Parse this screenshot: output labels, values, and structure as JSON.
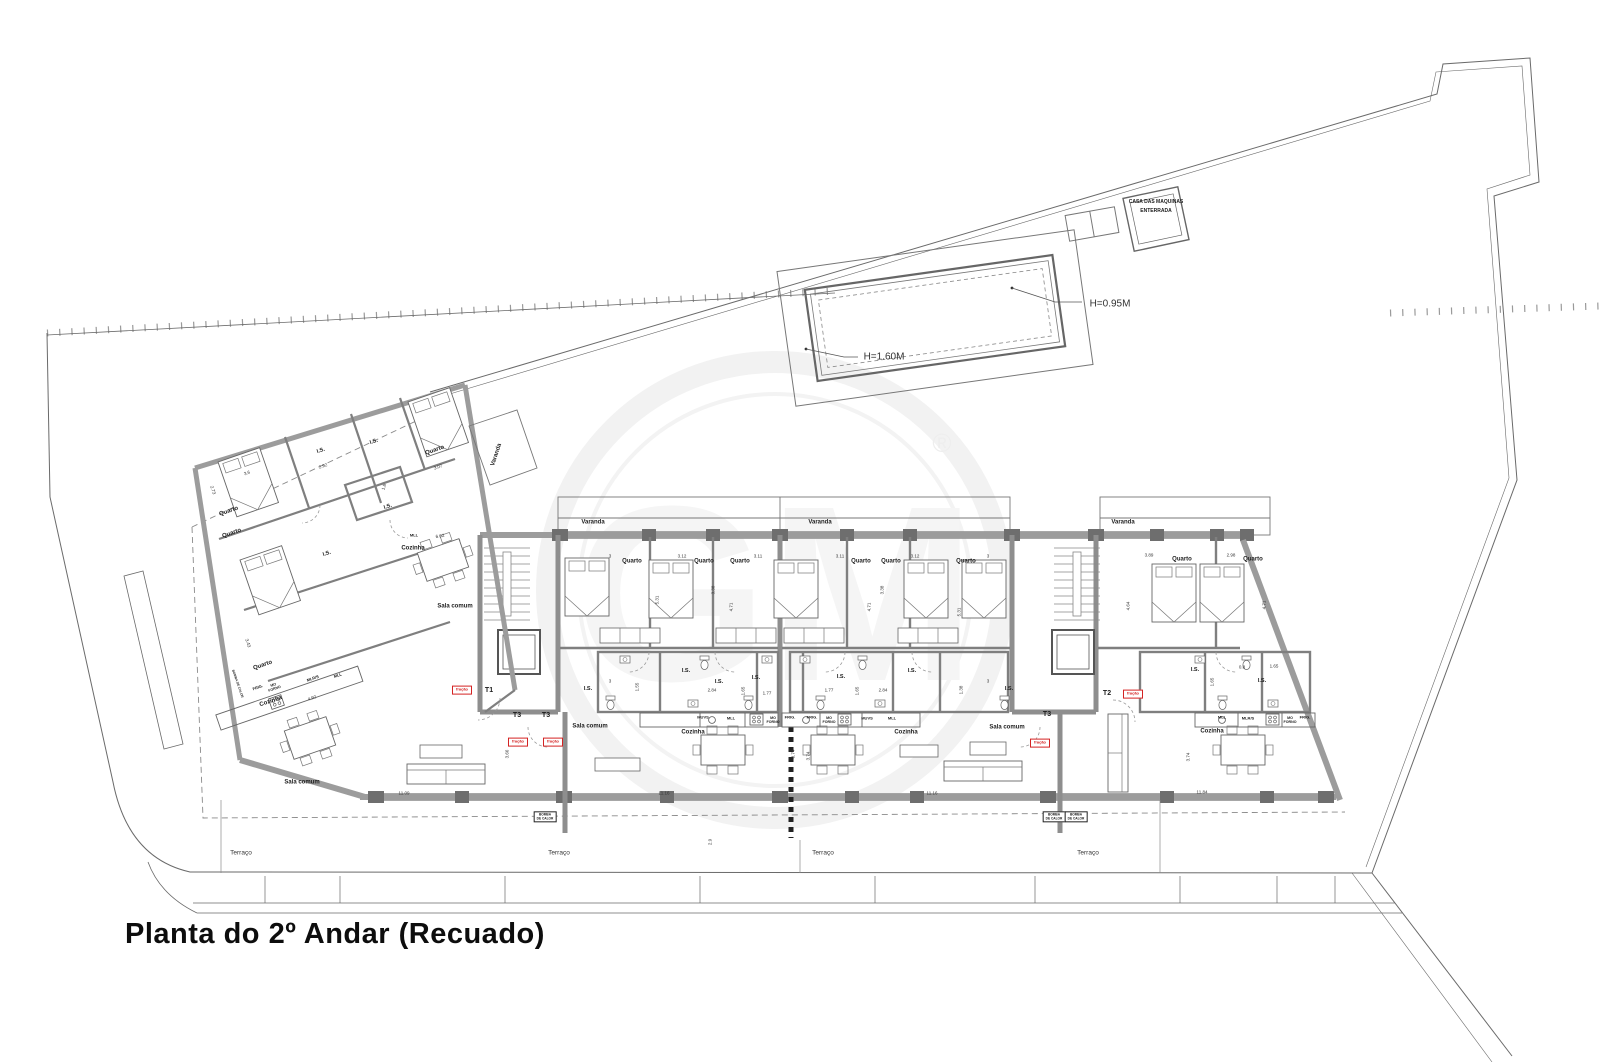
{
  "title": "Planta do 2º Andar (Recuado)",
  "watermark": {
    "text": "GM",
    "reg": "®"
  },
  "pool": {
    "depth_deep": "H=1.60M",
    "depth_shallow": "H=0.95M",
    "machine_house_line1": "CASA DAS MAQUINAS",
    "machine_house_line2": "ENTERRADA"
  },
  "unit_tags": [
    "T1",
    "T3",
    "T3",
    "T3",
    "T2"
  ],
  "fraction_tags": [
    {
      "t": "fração",
      "x": 462,
      "y": 690
    },
    {
      "t": "fração",
      "x": 518,
      "y": 742
    },
    {
      "t": "fração",
      "x": 553,
      "y": 742
    },
    {
      "t": "fração",
      "x": 1040,
      "y": 743
    },
    {
      "t": "fração",
      "x": 1133,
      "y": 694
    }
  ],
  "labels": [
    {
      "t": "H=0.95M",
      "x": 1110,
      "y": 304,
      "s": 10,
      "b": 0
    },
    {
      "t": "H=1.60M",
      "x": 884,
      "y": 357,
      "s": 10,
      "b": 0
    },
    {
      "t": "CASA DAS MAQUINAS",
      "x": 1156,
      "y": 203,
      "s": 5,
      "b": 1
    },
    {
      "t": "ENTERRADA",
      "x": 1156,
      "y": 212,
      "s": 5,
      "b": 1
    },
    {
      "t": "Varanda",
      "x": 593,
      "y": 523,
      "s": 6,
      "b": 1
    },
    {
      "t": "Varanda",
      "x": 820,
      "y": 523,
      "s": 6,
      "b": 1
    },
    {
      "t": "Varanda",
      "x": 1123,
      "y": 523,
      "s": 6,
      "b": 1
    },
    {
      "t": "Varanda",
      "x": 497,
      "y": 455,
      "s": 6,
      "b": 1,
      "r": -72
    },
    {
      "t": "Quarto",
      "x": 632,
      "y": 562,
      "s": 6,
      "b": 1
    },
    {
      "t": "Quarto",
      "x": 704,
      "y": 562,
      "s": 6,
      "b": 1
    },
    {
      "t": "Quarto",
      "x": 740,
      "y": 562,
      "s": 6,
      "b": 1
    },
    {
      "t": "Quarto",
      "x": 861,
      "y": 562,
      "s": 6,
      "b": 1
    },
    {
      "t": "Quarto",
      "x": 891,
      "y": 562,
      "s": 6,
      "b": 1
    },
    {
      "t": "Quarto",
      "x": 966,
      "y": 562,
      "s": 6,
      "b": 1
    },
    {
      "t": "Quarto",
      "x": 1182,
      "y": 560,
      "s": 6,
      "b": 1
    },
    {
      "t": "Quarto",
      "x": 1253,
      "y": 560,
      "s": 6,
      "b": 1
    },
    {
      "t": "Quarto",
      "x": 229,
      "y": 512,
      "s": 6,
      "b": 1,
      "r": -19
    },
    {
      "t": "Quarto",
      "x": 232,
      "y": 534,
      "s": 6,
      "b": 1,
      "r": -19
    },
    {
      "t": "Quarto",
      "x": 435,
      "y": 451,
      "s": 6,
      "b": 1,
      "r": -19
    },
    {
      "t": "Quarto",
      "x": 263,
      "y": 666,
      "s": 6,
      "b": 1,
      "r": -19
    },
    {
      "t": "I.S.",
      "x": 321,
      "y": 451,
      "s": 5.5,
      "b": 1,
      "r": -19
    },
    {
      "t": "I.S.",
      "x": 374,
      "y": 442,
      "s": 5.5,
      "b": 1,
      "r": -19
    },
    {
      "t": "I.S.",
      "x": 388,
      "y": 507,
      "s": 5.5,
      "b": 1,
      "r": -19
    },
    {
      "t": "I.S.",
      "x": 327,
      "y": 554,
      "s": 5.5,
      "b": 1,
      "r": -19
    },
    {
      "t": "I.S.",
      "x": 588,
      "y": 689,
      "s": 5.5,
      "b": 1
    },
    {
      "t": "I.S.",
      "x": 686,
      "y": 671,
      "s": 5.5,
      "b": 1
    },
    {
      "t": "I.S.",
      "x": 719,
      "y": 682,
      "s": 5.5,
      "b": 1
    },
    {
      "t": "I.S.",
      "x": 756,
      "y": 678,
      "s": 5.5,
      "b": 1
    },
    {
      "t": "I.S.",
      "x": 841,
      "y": 677,
      "s": 5.5,
      "b": 1
    },
    {
      "t": "I.S.",
      "x": 912,
      "y": 671,
      "s": 5.5,
      "b": 1
    },
    {
      "t": "I.S.",
      "x": 1009,
      "y": 689,
      "s": 5.5,
      "b": 1
    },
    {
      "t": "I.S.",
      "x": 1195,
      "y": 670,
      "s": 5.5,
      "b": 1
    },
    {
      "t": "I.S.",
      "x": 1262,
      "y": 681,
      "s": 5.5,
      "b": 1
    },
    {
      "t": "Cozinha",
      "x": 413,
      "y": 549,
      "s": 6,
      "b": 1
    },
    {
      "t": "Cozinha",
      "x": 271,
      "y": 702,
      "s": 6,
      "b": 1,
      "r": -19
    },
    {
      "t": "Cozinha",
      "x": 693,
      "y": 733,
      "s": 6,
      "b": 1
    },
    {
      "t": "Cozinha",
      "x": 906,
      "y": 733,
      "s": 6,
      "b": 1
    },
    {
      "t": "Cozinha",
      "x": 1212,
      "y": 732,
      "s": 6,
      "b": 1
    },
    {
      "t": "Sala comum",
      "x": 455,
      "y": 607,
      "s": 6,
      "b": 1
    },
    {
      "t": "Sala comum",
      "x": 302,
      "y": 783,
      "s": 6,
      "b": 1
    },
    {
      "t": "Sala comum",
      "x": 590,
      "y": 727,
      "s": 6,
      "b": 1
    },
    {
      "t": "Sala comum",
      "x": 1007,
      "y": 728,
      "s": 6,
      "b": 1
    },
    {
      "t": "MUVS",
      "x": 703,
      "y": 718,
      "s": 4,
      "b": 1
    },
    {
      "t": "MLL",
      "x": 731,
      "y": 719,
      "s": 4,
      "b": 1
    },
    {
      "t": "MO\nFORNO",
      "x": 773,
      "y": 720,
      "s": 3.6,
      "b": 1
    },
    {
      "t": "FRIG.",
      "x": 790,
      "y": 718,
      "s": 4,
      "b": 1
    },
    {
      "t": "FRIG.",
      "x": 812,
      "y": 718,
      "s": 4,
      "b": 1
    },
    {
      "t": "MO\nFORNO",
      "x": 829,
      "y": 720,
      "s": 3.6,
      "b": 1
    },
    {
      "t": "MUVS",
      "x": 867,
      "y": 719,
      "s": 4,
      "b": 1
    },
    {
      "t": "MLL",
      "x": 892,
      "y": 719,
      "s": 4,
      "b": 1
    },
    {
      "t": "MLL",
      "x": 1222,
      "y": 718,
      "s": 4,
      "b": 1
    },
    {
      "t": "MLR/S",
      "x": 1248,
      "y": 719,
      "s": 4,
      "b": 1
    },
    {
      "t": "MO\nFORNO",
      "x": 1290,
      "y": 720,
      "s": 3.6,
      "b": 1
    },
    {
      "t": "FRIG.",
      "x": 1305,
      "y": 718,
      "s": 4,
      "b": 1
    },
    {
      "t": "FRIG.",
      "x": 258,
      "y": 688,
      "s": 4,
      "b": 1,
      "r": -19
    },
    {
      "t": "MO\nFORNO",
      "x": 274,
      "y": 687,
      "s": 3.6,
      "b": 1,
      "r": -19
    },
    {
      "t": "MLR/S",
      "x": 313,
      "y": 679,
      "s": 4,
      "b": 1,
      "r": -19
    },
    {
      "t": "MLL",
      "x": 338,
      "y": 676,
      "s": 4,
      "b": 1,
      "r": -19
    },
    {
      "t": "MLL",
      "x": 414,
      "y": 536,
      "s": 4,
      "b": 1
    },
    {
      "t": "T1",
      "x": 489,
      "y": 691,
      "s": 7,
      "b": 1
    },
    {
      "t": "T3",
      "x": 517,
      "y": 716,
      "s": 7,
      "b": 1
    },
    {
      "t": "T3",
      "x": 546,
      "y": 716,
      "s": 7,
      "b": 1
    },
    {
      "t": "T3",
      "x": 1047,
      "y": 715,
      "s": 7,
      "b": 1
    },
    {
      "t": "T2",
      "x": 1107,
      "y": 694,
      "s": 7,
      "b": 1
    },
    {
      "t": "Terraço",
      "x": 241,
      "y": 853,
      "s": 6.5,
      "b": 0
    },
    {
      "t": "Terraço",
      "x": 559,
      "y": 853,
      "s": 6.5,
      "b": 0
    },
    {
      "t": "Terraço",
      "x": 823,
      "y": 853,
      "s": 6.5,
      "b": 0
    },
    {
      "t": "Terraço",
      "x": 1088,
      "y": 853,
      "s": 6.5,
      "b": 0
    },
    {
      "t": "BOMBA\nDE CALOR",
      "x": 545,
      "y": 817,
      "s": 3.2,
      "b": 1,
      "box": 1
    },
    {
      "t": "BOMBA\nDE CALOR",
      "x": 1054,
      "y": 817,
      "s": 3.2,
      "b": 1,
      "box": 1
    },
    {
      "t": "BOMBA\nDE CALOR",
      "x": 1076,
      "y": 817,
      "s": 3.2,
      "b": 1,
      "box": 1
    },
    {
      "t": "BOMBA DE CALOR",
      "x": 237,
      "y": 684,
      "s": 3.2,
      "b": 1,
      "r": 71
    },
    {
      "t": "3",
      "x": 610,
      "y": 556,
      "s": 4.5,
      "b": 0
    },
    {
      "t": "3.12",
      "x": 682,
      "y": 556,
      "s": 4.5,
      "b": 0
    },
    {
      "t": "3.11",
      "x": 758,
      "y": 556,
      "s": 4.5,
      "b": 0
    },
    {
      "t": "3.11",
      "x": 840,
      "y": 556,
      "s": 4.5,
      "b": 0
    },
    {
      "t": "3.12",
      "x": 915,
      "y": 556,
      "s": 4.5,
      "b": 0
    },
    {
      "t": "3",
      "x": 988,
      "y": 556,
      "s": 4.5,
      "b": 0
    },
    {
      "t": "3.89",
      "x": 1149,
      "y": 555,
      "s": 4.5,
      "b": 0
    },
    {
      "t": "2.98",
      "x": 1231,
      "y": 555,
      "s": 4.5,
      "b": 0
    },
    {
      "t": "5.31",
      "x": 657,
      "y": 600,
      "s": 4.5,
      "b": 0,
      "r": -90
    },
    {
      "t": "3.38",
      "x": 713,
      "y": 590,
      "s": 4.5,
      "b": 0,
      "r": -90
    },
    {
      "t": "4.71",
      "x": 731,
      "y": 607,
      "s": 4.5,
      "b": 0,
      "r": -90
    },
    {
      "t": "4.71",
      "x": 869,
      "y": 607,
      "s": 4.5,
      "b": 0,
      "r": -90
    },
    {
      "t": "3.38",
      "x": 882,
      "y": 590,
      "s": 4.5,
      "b": 0,
      "r": -90
    },
    {
      "t": "5.31",
      "x": 959,
      "y": 612,
      "s": 4.5,
      "b": 0,
      "r": -90
    },
    {
      "t": "4.64",
      "x": 1128,
      "y": 606,
      "s": 4.5,
      "b": 0,
      "r": -90
    },
    {
      "t": "4.71",
      "x": 1264,
      "y": 605,
      "s": 4.5,
      "b": 0,
      "r": -90
    },
    {
      "t": "3",
      "x": 610,
      "y": 681,
      "s": 4.5,
      "b": 0
    },
    {
      "t": "1.55",
      "x": 637,
      "y": 687,
      "s": 4.5,
      "b": 0,
      "r": -90
    },
    {
      "t": "2.84",
      "x": 712,
      "y": 690,
      "s": 4.5,
      "b": 0
    },
    {
      "t": "1.65",
      "x": 743,
      "y": 691,
      "s": 4.5,
      "b": 0,
      "r": -90
    },
    {
      "t": "1.77",
      "x": 767,
      "y": 693,
      "s": 4.5,
      "b": 0
    },
    {
      "t": "1.77",
      "x": 829,
      "y": 690,
      "s": 4.5,
      "b": 0
    },
    {
      "t": "1.65",
      "x": 857,
      "y": 691,
      "s": 4.5,
      "b": 0,
      "r": -90
    },
    {
      "t": "2.84",
      "x": 883,
      "y": 690,
      "s": 4.5,
      "b": 0
    },
    {
      "t": "1.38",
      "x": 961,
      "y": 690,
      "s": 4.5,
      "b": 0,
      "r": -90
    },
    {
      "t": "3",
      "x": 988,
      "y": 681,
      "s": 4.5,
      "b": 0
    },
    {
      "t": "0.8",
      "x": 1242,
      "y": 667,
      "s": 4.5,
      "b": 0
    },
    {
      "t": "1.65",
      "x": 1274,
      "y": 666,
      "s": 4.5,
      "b": 0
    },
    {
      "t": "1.65",
      "x": 1212,
      "y": 682,
      "s": 4.5,
      "b": 0,
      "r": -90
    },
    {
      "t": "11.09",
      "x": 404,
      "y": 793,
      "s": 4.5,
      "b": 0
    },
    {
      "t": "11.16",
      "x": 664,
      "y": 793,
      "s": 4.5,
      "b": 0
    },
    {
      "t": "11.16",
      "x": 932,
      "y": 793,
      "s": 4.5,
      "b": 0
    },
    {
      "t": "11.84",
      "x": 1202,
      "y": 792,
      "s": 4.5,
      "b": 0
    },
    {
      "t": "3.66",
      "x": 507,
      "y": 754,
      "s": 4.5,
      "b": 0,
      "r": -90
    },
    {
      "t": "3.74",
      "x": 793,
      "y": 754,
      "s": 4.5,
      "b": 0,
      "r": -90
    },
    {
      "t": "3.74",
      "x": 808,
      "y": 756,
      "s": 4.5,
      "b": 0,
      "r": -90
    },
    {
      "t": "3.74",
      "x": 1188,
      "y": 757,
      "s": 4.5,
      "b": 0,
      "r": -90
    },
    {
      "t": "2.9",
      "x": 710,
      "y": 842,
      "s": 4.5,
      "b": 0,
      "r": -90
    },
    {
      "t": "2.92",
      "x": 323,
      "y": 466,
      "s": 4.5,
      "b": 0,
      "r": -19
    },
    {
      "t": "3.6",
      "x": 247,
      "y": 473,
      "s": 4.5,
      "b": 0,
      "r": -19
    },
    {
      "t": "2.73",
      "x": 213,
      "y": 490,
      "s": 4.5,
      "b": 0,
      "r": 71
    },
    {
      "t": "3.07",
      "x": 438,
      "y": 467,
      "s": 4.5,
      "b": 0,
      "r": -19
    },
    {
      "t": "3.43",
      "x": 248,
      "y": 643,
      "s": 4.5,
      "b": 0,
      "r": 71
    },
    {
      "t": "4.92",
      "x": 312,
      "y": 698,
      "s": 4.5,
      "b": 0,
      "r": -19
    },
    {
      "t": "6.02",
      "x": 440,
      "y": 536,
      "s": 4.5,
      "b": 0,
      "r": -10
    },
    {
      "t": "1.8",
      "x": 384,
      "y": 487,
      "s": 4.5,
      "b": 0,
      "r": -72
    }
  ]
}
